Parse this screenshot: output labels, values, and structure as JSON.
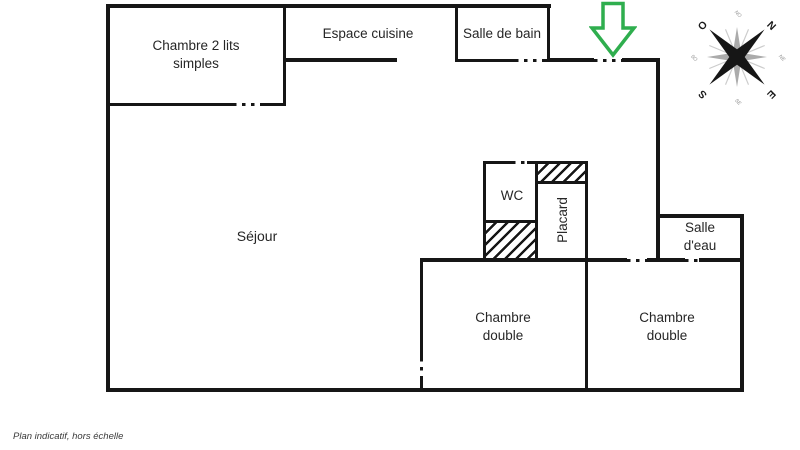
{
  "footer": {
    "note": "Plan indicatif, hors échelle"
  },
  "colors": {
    "wall": "#161616",
    "arrow_green": "#2fae4e",
    "text": "#262626"
  },
  "rooms": {
    "twin_bedroom": {
      "label": "Chambre 2 lits simples"
    },
    "kitchen": {
      "label": "Espace cuisine"
    },
    "bathroom": {
      "label": "Salle de bain"
    },
    "living_room": {
      "label": "Séjour"
    },
    "wc": {
      "label": "WC"
    },
    "closet": {
      "label": "Placard"
    },
    "shower_room": {
      "label": "Salle d'eau"
    },
    "double_bedroom_left": {
      "label": "Chambre double"
    },
    "double_bedroom_right": {
      "label": "Chambre double"
    }
  },
  "compass": {
    "n": "N",
    "e": "E",
    "s": "S",
    "o": "O",
    "ne": "NE",
    "no": "NO",
    "se": "SE",
    "so": "SO"
  }
}
